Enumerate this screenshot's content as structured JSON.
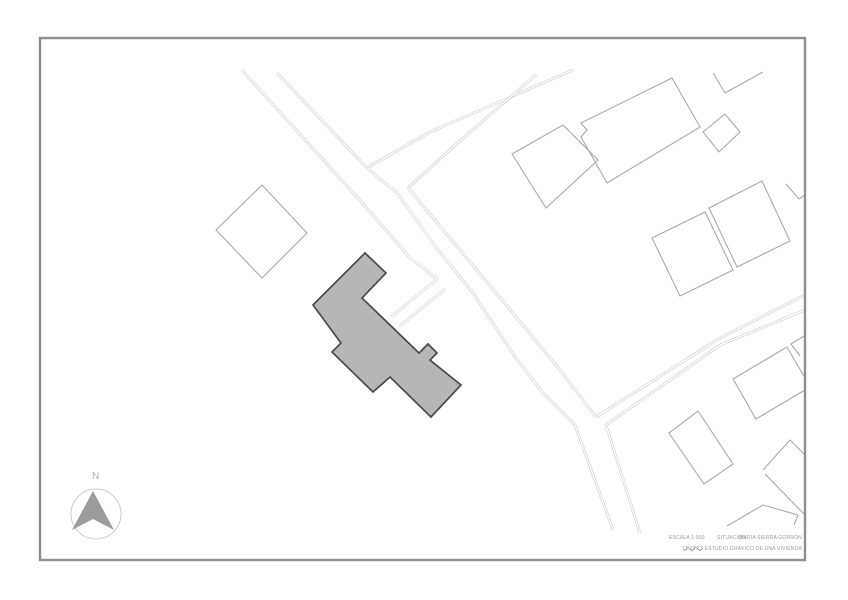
{
  "title_block": {
    "scale_label": "ESCALA 1:500",
    "drawing_label": "SITUACIÓN",
    "author": "MARÍA SIERRA GORRÓN",
    "footer": "11.12.13 ESTUDIO GRÁFICO DE UNA VIVIENDA"
  },
  "north_arrow": {
    "label": "N",
    "circle": {
      "cx": 96,
      "cy": 514,
      "r": 25
    },
    "arrow_points": "93,491 114,530 93,519 72,530"
  },
  "colors": {
    "road": "#c6c6c6",
    "road_core": "#ffffff",
    "outline": "#a9a9a9",
    "building_fill": "#b6b6b6",
    "building_stroke": "#4a4a4a",
    "frame": "#8f8f8f",
    "circle": "#cccccc",
    "arrow": "#9c9c9c",
    "text": "#9b9b9b",
    "signature": "#8a8a8a"
  },
  "frame": {
    "x": 40,
    "y": 38,
    "w": 765,
    "h": 522
  },
  "site_plan": {
    "roads": [
      {
        "name": "nw-road-left-parcel-edge",
        "points": "242,70 373,215 410,258 437,279 391,317"
      },
      {
        "name": "nw-road-right",
        "points": "277,73 367,168"
      },
      {
        "name": "ne-road-upper",
        "points": "367,168 430,132 573,70"
      },
      {
        "name": "ne-road-lower",
        "points": "408,188 452,148 537,74"
      },
      {
        "name": "main-road-left",
        "points": "367,168 397,193 438,250 473,293 515,357 543,393 575,425 613,530"
      },
      {
        "name": "main-road-right",
        "points": "408,188 460,250 512,312 560,370 596,417"
      },
      {
        "name": "east-road-upper",
        "points": "805,295 720,338 596,417"
      },
      {
        "name": "east-road-lower",
        "points": "805,310 720,345 606,425 640,533"
      },
      {
        "name": "driveway-spur",
        "points": "445,289 400,326"
      }
    ],
    "buildings": [
      {
        "name": "main-house",
        "filled": true,
        "points": "365,253 386,273 362,298 419,353 428,344 437,353 430,360 461,385 431,417 390,377 373,392 332,352 341,343 313,305"
      },
      {
        "name": "diamond-west",
        "points": "262,185 307,233 262,278 216,230"
      },
      {
        "name": "big-north-building",
        "points": "672,78 700,127 607,183 581,137 587,130 581,123"
      },
      {
        "name": "square-north-building",
        "points": "563,125 598,160 546,208 512,154"
      },
      {
        "name": "small-diamond-north",
        "points": "725,114 740,132 719,152 703,132"
      },
      {
        "name": "ne-parcel-1",
        "points": "762,181 790,241 737,267 709,208"
      },
      {
        "name": "ne-parcel-2",
        "points": "705,212 733,270 680,296 652,238"
      },
      {
        "name": "mid-right-building",
        "points": "698,411 733,464 704,484 669,433"
      },
      {
        "name": "right-clipped-building",
        "points": "787,347 733,379 756,419 805,390 805,378"
      }
    ],
    "outlines": [
      {
        "name": "top-right-partial",
        "points": "713,73 725,93 763,72"
      },
      {
        "name": "right-corner-partial",
        "points": "804,336 791,344 800,356"
      },
      {
        "name": "right-upper-partial",
        "points": "786,184 799,199 805,195"
      },
      {
        "name": "se-corner-partial",
        "points": "806,456 790,440 763,470"
      },
      {
        "name": "se-edge-partial",
        "points": "765,474 804,514"
      },
      {
        "name": "south-house-partial",
        "points": "727,526 763,505 798,515 794,525"
      }
    ],
    "signature_points": "684,551 688,547 692,551 696,547 700,551 703,548"
  }
}
